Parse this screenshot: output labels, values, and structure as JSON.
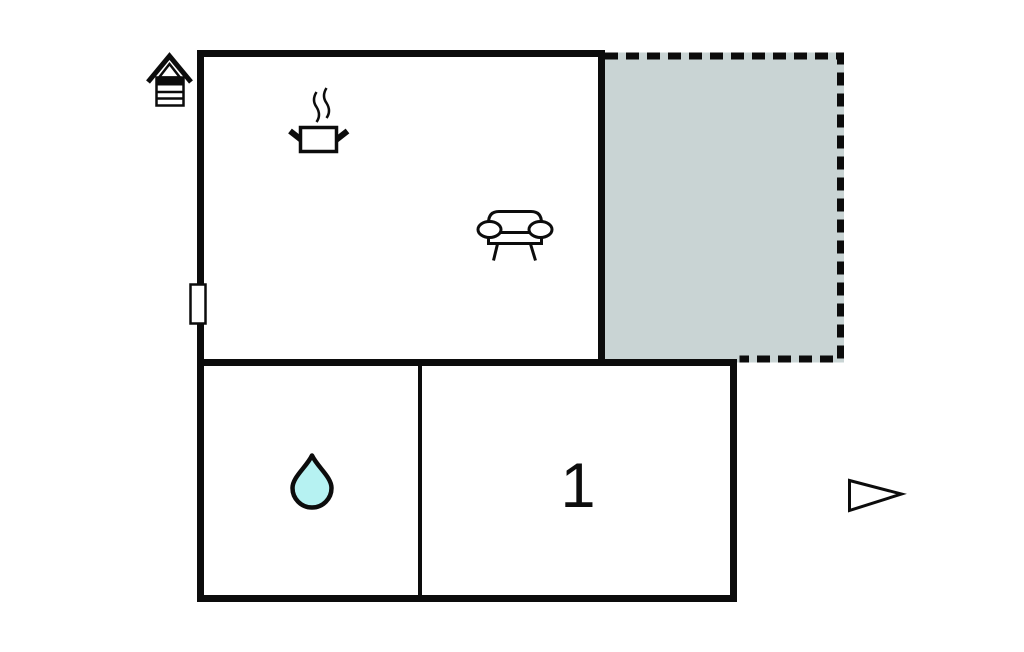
{
  "floorplan": {
    "rooms": [
      {
        "name": "living-room-kitchen",
        "icons": [
          "cooking-pot-icon",
          "sofa-icon"
        ],
        "label": ""
      },
      {
        "name": "terrace",
        "icons": [],
        "outline": "dashed",
        "label": ""
      },
      {
        "name": "bathroom",
        "icons": [
          "water-drop-icon"
        ],
        "label": ""
      },
      {
        "name": "bedroom",
        "icons": [],
        "label": "1"
      }
    ],
    "markers": [
      "chimney-icon",
      "window-marker",
      "direction-arrow-icon"
    ],
    "colors": {
      "wall": "#0c0c0c",
      "terrace_fill": "#c9d4d4",
      "water_drop_fill": "#b6f2f2",
      "background": "#ffffff"
    }
  }
}
